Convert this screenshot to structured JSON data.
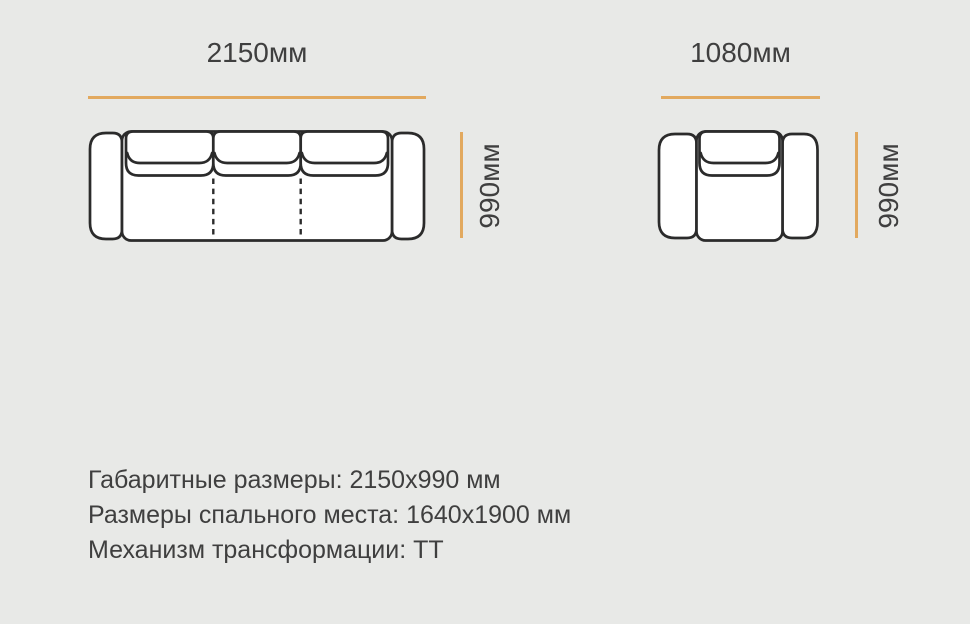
{
  "colors": {
    "background": "#e8e9e7",
    "accent": "#e2a95f",
    "line": "#2b2b2b",
    "text": "#3f3f3f"
  },
  "diagrams": {
    "sofa": {
      "width_label": "2150мм",
      "height_label": "990мм"
    },
    "armchair": {
      "width_label": "1080мм",
      "height_label": "990мм"
    }
  },
  "specs": {
    "overall_dimensions": "Габаритные размеры: 2150x990 мм",
    "sleeping_area": "Размеры спального места: 1640x1900 мм",
    "mechanism": "Механизм трансформации: ТТ"
  }
}
